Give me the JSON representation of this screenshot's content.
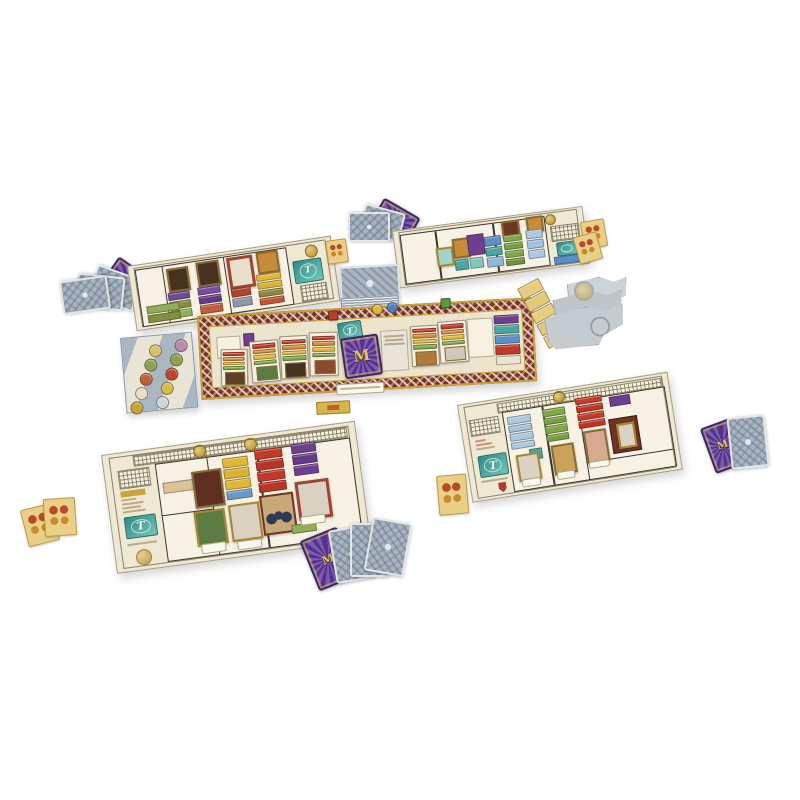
{
  "scene": {
    "description": "Product photograph of a board game set up on a white surface: four cream mansion player boards with black floor-plan walls, colored room tiles and gold-framed paintings; a central carpet-bordered market board holding room cards, a purple starburst deck and tokens; fans and decks of gray patterned cards, purple cards, small tan cards, a gray token tray with round tokens, and stacked gray punchboard sheets.",
    "background": "#ffffff"
  },
  "glyphs": {
    "deck_letter": "M",
    "theatre_letter": "T"
  },
  "palette": {
    "cream": "#efe8d2",
    "carpetMaroon": "#7c3026",
    "carpetGold": "#c9a13c",
    "carpetCream": "#ece4cd",
    "grayBoard": "#aab6c2",
    "cardGray": "#a9b4c0",
    "cardPurple": "#5a3890",
    "teal": "#3f9e96",
    "tan": "#ead087",
    "gold": "#d4af3a",
    "red": "#c0392b",
    "orange": "#d88b2f",
    "yellow": "#dfb83a",
    "green": "#7ea84a",
    "sky": "#abc9e2",
    "blue": "#5b8fc9",
    "purpleTile": "#6d3f8e",
    "maroon": "#6e3424"
  },
  "boards": {
    "top_left": {
      "rooms": {
        "r1": [
          "#6d4a9a",
          "#80903f",
          "#8fae55"
        ],
        "r2": [
          "#7a4aa6",
          "#63398e",
          "#c05a3a"
        ],
        "r3": [
          "#b0452e",
          "#8d97a5"
        ],
        "r4": [
          "#dfb83a",
          "#d9b434",
          "#8a8a3a",
          "#c0542e"
        ]
      }
    },
    "top_right": {
      "rooms": {
        "r1": [
          "#4aa79f",
          "#7fc7bf"
        ],
        "r2": [
          "#5b8fc9",
          "#4aa79f",
          "#8fb8d8"
        ],
        "r3": [
          "#7ea84a",
          "#74a042",
          "#7ea84a",
          "#6a9440"
        ],
        "r4": [
          "#abc9e2",
          "#a1c2de",
          "#abc9e2"
        ]
      }
    },
    "bottom_left": {
      "cols": {
        "c1": [
          "#dfb83a",
          "#d9b434",
          "#dfb83a",
          "#6b9ac9"
        ],
        "c2": [
          "#c0392b",
          "#b93527",
          "#c0392b",
          "#b93527"
        ],
        "c3": [
          "#6d3f8e",
          "#663a86",
          "#6d3f8e"
        ]
      }
    },
    "bottom_right": {
      "cols": {
        "c1": [
          "#abc9e2",
          "#a1c2de",
          "#abc9e2",
          "#abc9e2"
        ],
        "c2": [
          "#7ea84a",
          "#74a042",
          "#7ea84a",
          "#74a042"
        ],
        "c3": [
          "#c53a28",
          "#bf3522",
          "#c53a28",
          "#bf3522"
        ]
      }
    },
    "central": {
      "card_strips": [
        "#c0392b",
        "#d88b2f",
        "#dfb83a",
        "#7ea84a"
      ],
      "right_cluster": [
        "#6d3f8e",
        "#4aa79f",
        "#5b8fc9",
        "#c0392b",
        "#e9e2cf"
      ],
      "tokens": [
        {
          "shape": "disc",
          "color": "#dfb83a"
        },
        {
          "shape": "disc",
          "color": "#4a7fc9"
        },
        {
          "shape": "square",
          "color": "#55a03a"
        },
        {
          "shape": "square",
          "color": "#bf3a2b"
        }
      ]
    }
  },
  "token_tray": {
    "col_a": [
      "#d9c06a",
      "#8fa050",
      "#c05f3a",
      "#e6dec6",
      "#caa23c"
    ],
    "col_b": [
      "#b98ab0",
      "#8fa050",
      "#c0452e",
      "#d9b84a",
      "#cfd6dc"
    ]
  },
  "tan_column": [
    "#e7cd7d",
    "#e3c878",
    "#e7cd7d",
    "#e3c878",
    "#e7cd7d"
  ]
}
